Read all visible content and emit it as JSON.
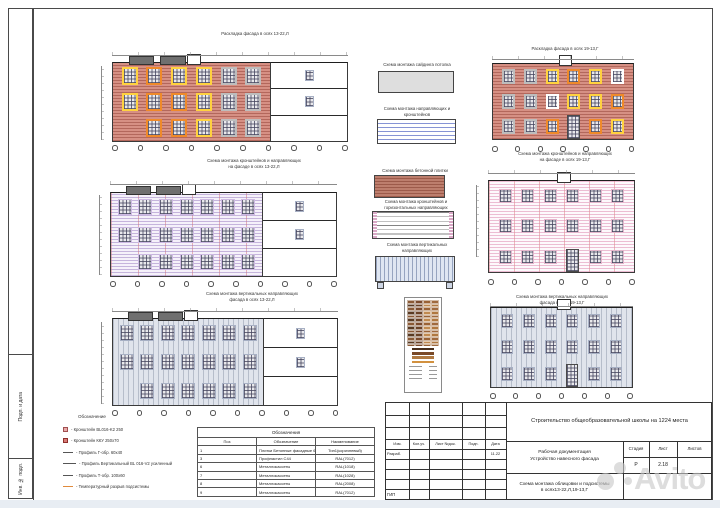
{
  "titleblock": {
    "project": "Строительство общеобразовательной школы на 1224 места",
    "doc_type": "Рабочая документация\nУстройство навесного фасада",
    "sheet_title": "Схема монтажа облицовки и подсистемы\nв осях13-22,Л,19-13,Г",
    "header_cols": [
      "Изм.",
      "Кол.уч.",
      "Лист №док.",
      "Подп.",
      "Дата"
    ],
    "razrab_label": "Разраб.",
    "date_value": "11.22",
    "gip_label": "ГИП",
    "stage_label": "Стадия",
    "sheet_label": "Лист",
    "sheets_label": "Листов",
    "stage_value": "Р",
    "sheet_value": "2.18",
    "sheets_value": ""
  },
  "sidebar_labels": {
    "podp": "Подп. и дата",
    "inv": "Инв. № подл."
  },
  "watermark": {
    "text": "Avito"
  },
  "legend": {
    "header": "Обозначение",
    "items": [
      {
        "sym": "sq-pink",
        "label": "Кронштейн BL016-K2 250"
      },
      {
        "sym": "sq-red",
        "label": "Кронштейн ККУ 250х70"
      },
      {
        "sym": "line",
        "label": "Профиль Г-обр. 60х40"
      },
      {
        "sym": "line-long",
        "label": "Профиль Вертикальный BL 016-V2 усиленный"
      },
      {
        "sym": "line",
        "label": "Профиль Т-обр. 100х60"
      },
      {
        "sym": "line-orange",
        "label": "Температурный разрыв подсистемы"
      }
    ]
  },
  "table": {
    "title": "Обозначения",
    "cols": [
      "Поз",
      "Обозначение",
      "Наименование"
    ],
    "rows": [
      [
        "1",
        "Плитки Бетонные фасадные 600х190",
        "Тип1(коричневый)"
      ],
      [
        "3",
        "Профнастил С44",
        "RAL(7012)"
      ],
      [
        "6",
        "Металлокассеты",
        "RAL(1018)"
      ],
      [
        "7",
        "Металлокассеты",
        "RAL(1028)"
      ],
      [
        "8",
        "Металлокассеты",
        "RAL(2008)"
      ],
      [
        "9",
        "Металлокассеты",
        "RAL(7012)"
      ]
    ]
  },
  "panels": [
    {
      "label": "Схема монтажа сайдинга потолка"
    },
    {
      "label": "Схема монтажа направляющих и\nкронштейнов"
    },
    {
      "label": "Схема монтажа бетонной плитки"
    },
    {
      "label": "Схема монтажа кронштейнов и\nгоризонтальных направляющих"
    },
    {
      "label": "Схема монтажа вертикальных\nнаправляющих"
    }
  ],
  "drawings": [
    {
      "name": "facade-layout-13-22",
      "title": "Раскладка фасада в осях 13-22,Л",
      "style": "brick",
      "section": true,
      "rooftop": true,
      "pent": true,
      "win": [
        "y o y y g g",
        "y o o y g g",
        "x o o y g g"
      ],
      "ww": 16,
      "wh": 18,
      "axes": 10
    },
    {
      "name": "facade-layout-19-13",
      "title": "Раскладка фасада в осях 19-13,Г",
      "style": "brick",
      "section": false,
      "rooftop": false,
      "pent": true,
      "win": [
        "g g y o y w",
        "g g w y y o",
        "g g o D o y"
      ],
      "ww": 13,
      "wh": 15,
      "axes": 7
    },
    {
      "name": "brackets-scheme-13-22",
      "title": "Схема монтажа кронштейнов и направляющих\nна фасаде в осях 13-22,Л",
      "style": "purple",
      "section": true,
      "rooftop": true,
      "pent": true,
      "win": [
        "p p p p p p p",
        "p p p p p p p",
        "x p p p p p p"
      ],
      "ww": 14,
      "wh": 16,
      "axes": 10
    },
    {
      "name": "brackets-scheme-19-13",
      "title": "Схема монтажа кронштейнов и направляющих\nна фасаде в осях 19-13,Г",
      "style": "pink",
      "section": false,
      "rooftop": false,
      "pent": true,
      "win": [
        "k k k k k k",
        "k k k k k k",
        "k k k D k k"
      ],
      "ww": 13,
      "wh": 14,
      "axes": 7
    },
    {
      "name": "verticals-scheme-13-22",
      "title": "Схема монтажа вертикальных направляющих\nфасада в осях 13-22,Л",
      "style": "gray",
      "section": true,
      "rooftop": true,
      "pent": true,
      "win": [
        "v v v v v v v",
        "v v v v v v v",
        "x v v v v v v"
      ],
      "ww": 14,
      "wh": 16,
      "axes": 10
    },
    {
      "name": "verticals-scheme-19-13",
      "title": "Схема монтажа вертикальных направляющих\nфасада в осях 19-13,Г",
      "style": "gray",
      "section": false,
      "rooftop": false,
      "pent": true,
      "win": [
        "v v v v v v",
        "v v v v v v",
        "v v v D v v"
      ],
      "ww": 12,
      "wh": 14,
      "axes": 7
    }
  ],
  "swatch": {
    "palette": [
      "#6b4226",
      "#8a5a36",
      "#a06a3e",
      "#c08a50",
      "#7a4a2c",
      "#5a3a22",
      "#b07840",
      "#9a6234"
    ],
    "bars": [
      "#4a2f1d",
      "#7a4a28",
      "#b07a42",
      "#d2913f"
    ]
  },
  "colors": {
    "accent_yellow": "#ffd23f",
    "accent_orange": "#ef8a2a",
    "brick": "#d69084",
    "watermark_gray": "#c9c9c9"
  }
}
